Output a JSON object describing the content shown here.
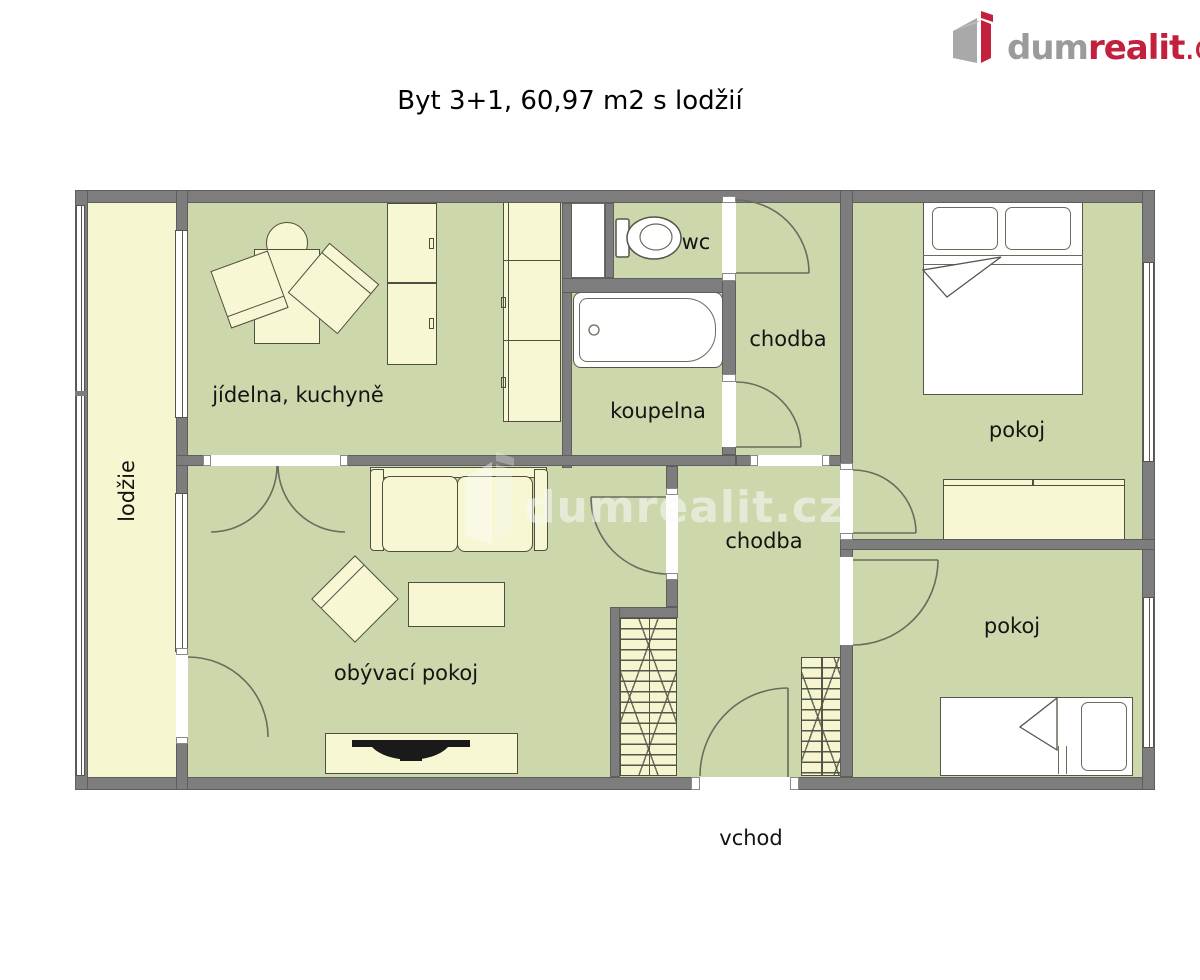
{
  "header": {
    "logo": {
      "part_gray": "dum",
      "part_red": "realit",
      "part_suffix": ".cz"
    }
  },
  "title": "Byt 3+1, 60,97 m2 s lodžií",
  "watermark": {
    "text": "dumrealit.cz"
  },
  "labels": {
    "loggia": "lodžie",
    "kitchen": "jídelna, kuchyně",
    "wc": "wc",
    "bathroom": "koupelna",
    "hall_top": "chodba",
    "hall_main": "chodba",
    "room_top": "pokoj",
    "room_bottom": "pokoj",
    "living_room": "obývací pokoj",
    "entrance": "vchod"
  },
  "colors": {
    "floor_green": "#ccd8ab",
    "floor_yellow": "#f6f6d0",
    "wall_gray": "#7d7d7d",
    "logo_gray": "#9b9b9b",
    "logo_red": "#c2203d"
  }
}
